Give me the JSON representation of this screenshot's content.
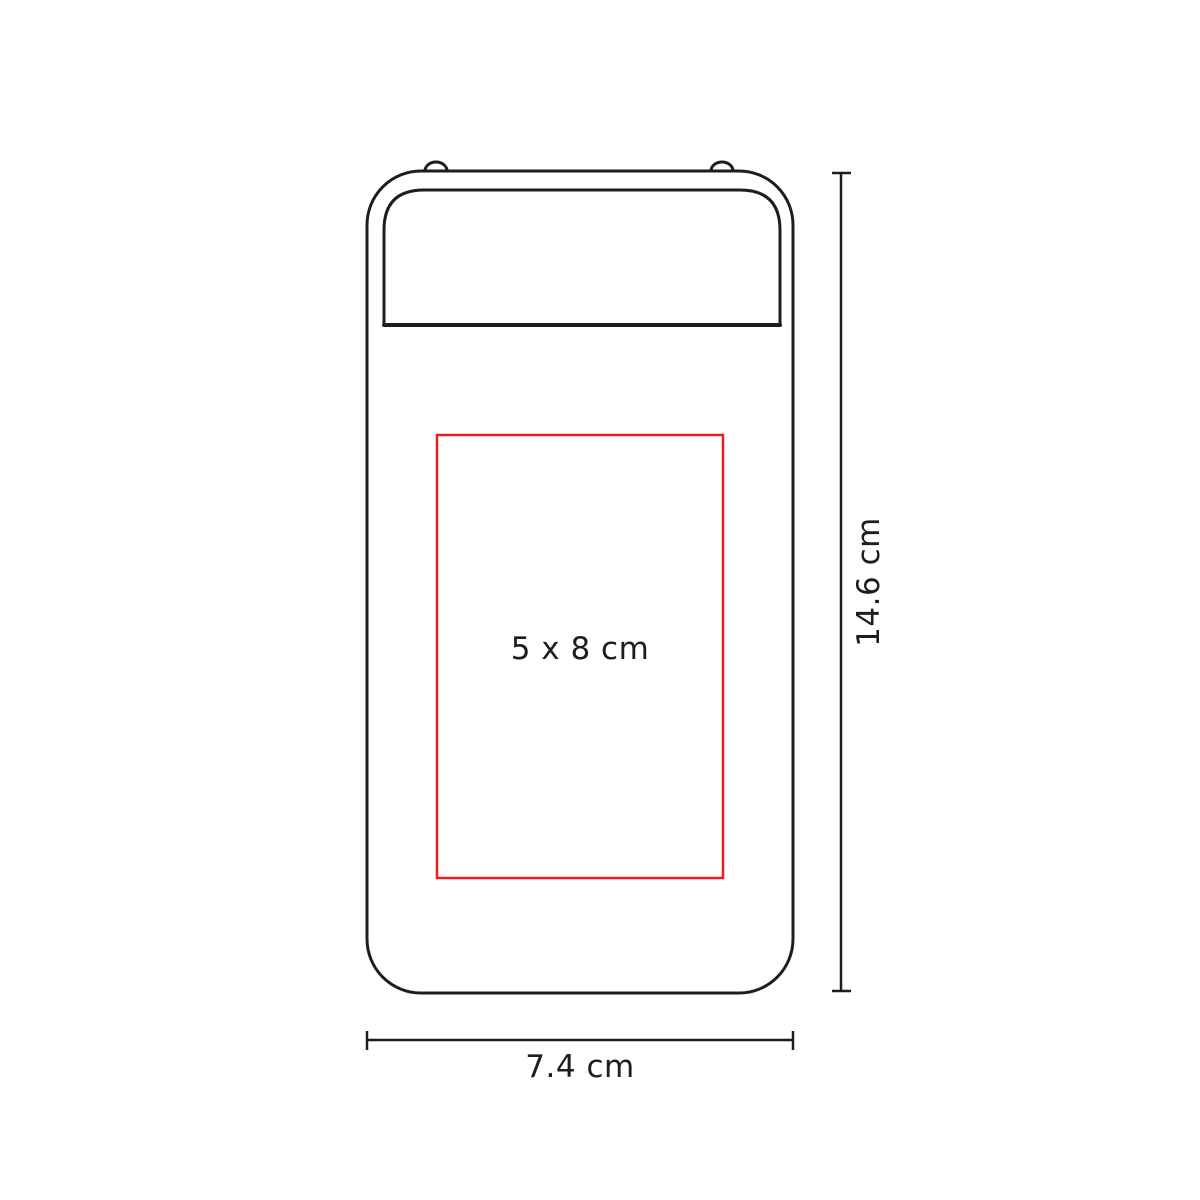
{
  "diagram": {
    "colors": {
      "outline": "#1d1d1b",
      "print_area": "#ec1c24",
      "background": "#ffffff"
    },
    "labels": {
      "print_area": "5 x 8 cm",
      "device_height": "14.6 cm",
      "device_width": "7.4 cm"
    }
  }
}
